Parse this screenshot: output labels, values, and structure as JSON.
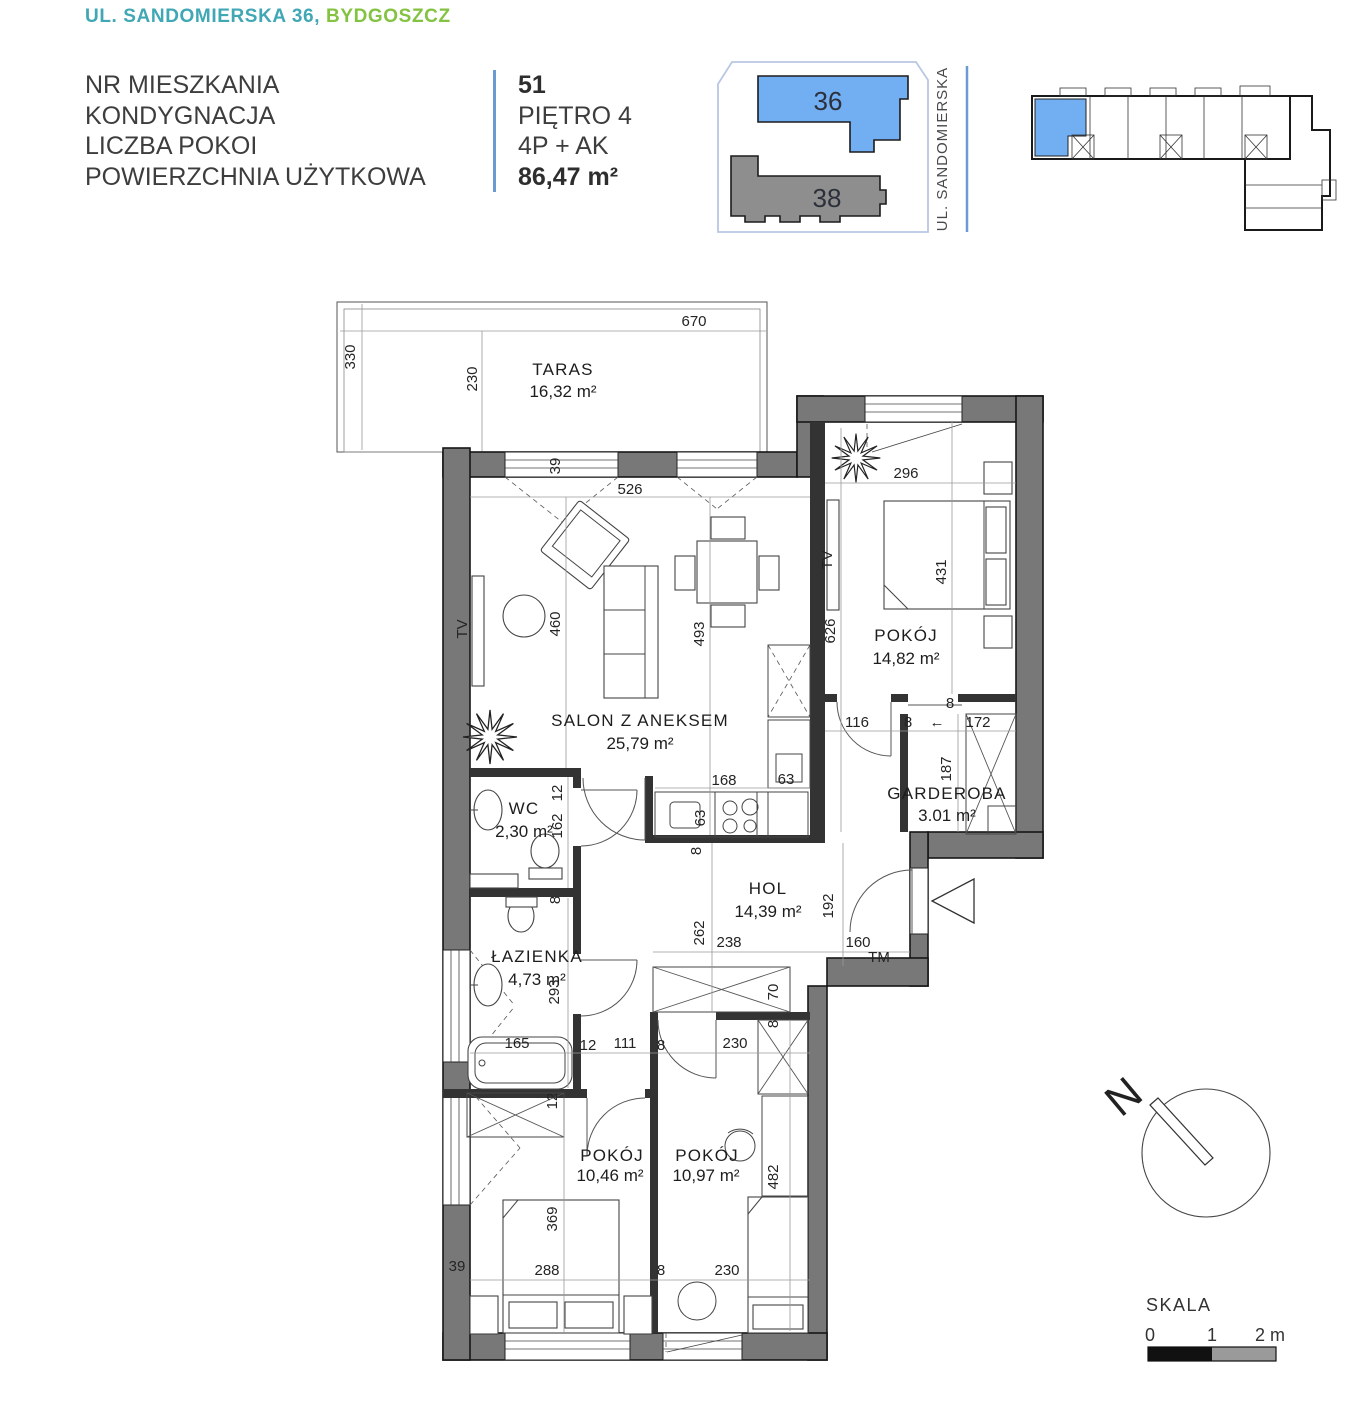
{
  "header": {
    "address_part1": "UL. SANDOMIERSKA 36,",
    "address_part2": "BYDGOSZCZ",
    "labels": {
      "unit_no": "NR MIESZKANIA",
      "floor": "KONDYGNACJA",
      "rooms": "LICZBA POKOI",
      "area": "POWIERZCHNIA UŻYTKOWA"
    },
    "values": {
      "unit_no": "51",
      "floor": "PIĘTRO 4",
      "rooms": "4P + AK",
      "area": "86,47 m²"
    }
  },
  "site_plan": {
    "building_a": "36",
    "building_b": "38",
    "street": "UL. SANDOMIERSKA"
  },
  "rooms": {
    "taras": {
      "name": "TARAS",
      "area": "16,32 m²"
    },
    "salon": {
      "name": "SALON Z ANEKSEM",
      "area": "25,79 m²"
    },
    "pokoj1": {
      "name": "POKÓJ",
      "area": "14,82 m²"
    },
    "garderoba": {
      "name": "GARDEROBA",
      "area": "3.01 m²"
    },
    "wc": {
      "name": "WC",
      "area": "2,30 m²"
    },
    "hol": {
      "name": "HOL",
      "area": "14,39 m²"
    },
    "lazienka": {
      "name": "ŁAZIENKA",
      "area": "4,73 m²"
    },
    "pokoj2": {
      "name": "POKÓJ",
      "area": "10,46 m²"
    },
    "pokoj3": {
      "name": "POKÓJ",
      "area": "10,97 m²"
    }
  },
  "dims": {
    "d670": "670",
    "d330": "330",
    "d230": "230",
    "d39": "39",
    "d526": "526",
    "d296": "296",
    "d460": "460",
    "d493": "493",
    "d626": "626",
    "d431": "431",
    "g116": "116",
    "g8": "8",
    "g172": "172",
    "g187": "187",
    "g8top": "8",
    "k168": "168",
    "k63a": "63",
    "k63b": "63",
    "k8": "8",
    "wc12": "12",
    "wc162": "162",
    "wc8": "8",
    "h262": "262",
    "h238": "238",
    "h192": "192",
    "h160": "160",
    "h70": "70",
    "h8": "8",
    "l293": "293",
    "l165": "165",
    "m12": "12",
    "m111": "111",
    "m8": "8",
    "m230": "230",
    "m12b": "12",
    "b369": "369",
    "b288": "288",
    "b8": "8",
    "b230": "230",
    "b482": "482",
    "b39": "39"
  },
  "labels": {
    "tv_a": "TV",
    "tv_b": "TV",
    "tm": "TM",
    "slide_arrow": "←"
  },
  "compass": {
    "north": "N"
  },
  "scale_bar": {
    "title": "SKALA",
    "tick0": "0",
    "tick1": "1",
    "tick2": "2 m"
  },
  "colors": {
    "accent_teal": "#40a7b5",
    "accent_green": "#84c341",
    "highlight_blue": "#72aef2",
    "building_gray": "#8e8e8e",
    "wall_gray": "#787878",
    "divider_blue": "#6b9bd2",
    "boundary_blue": "#b9c7e4"
  }
}
